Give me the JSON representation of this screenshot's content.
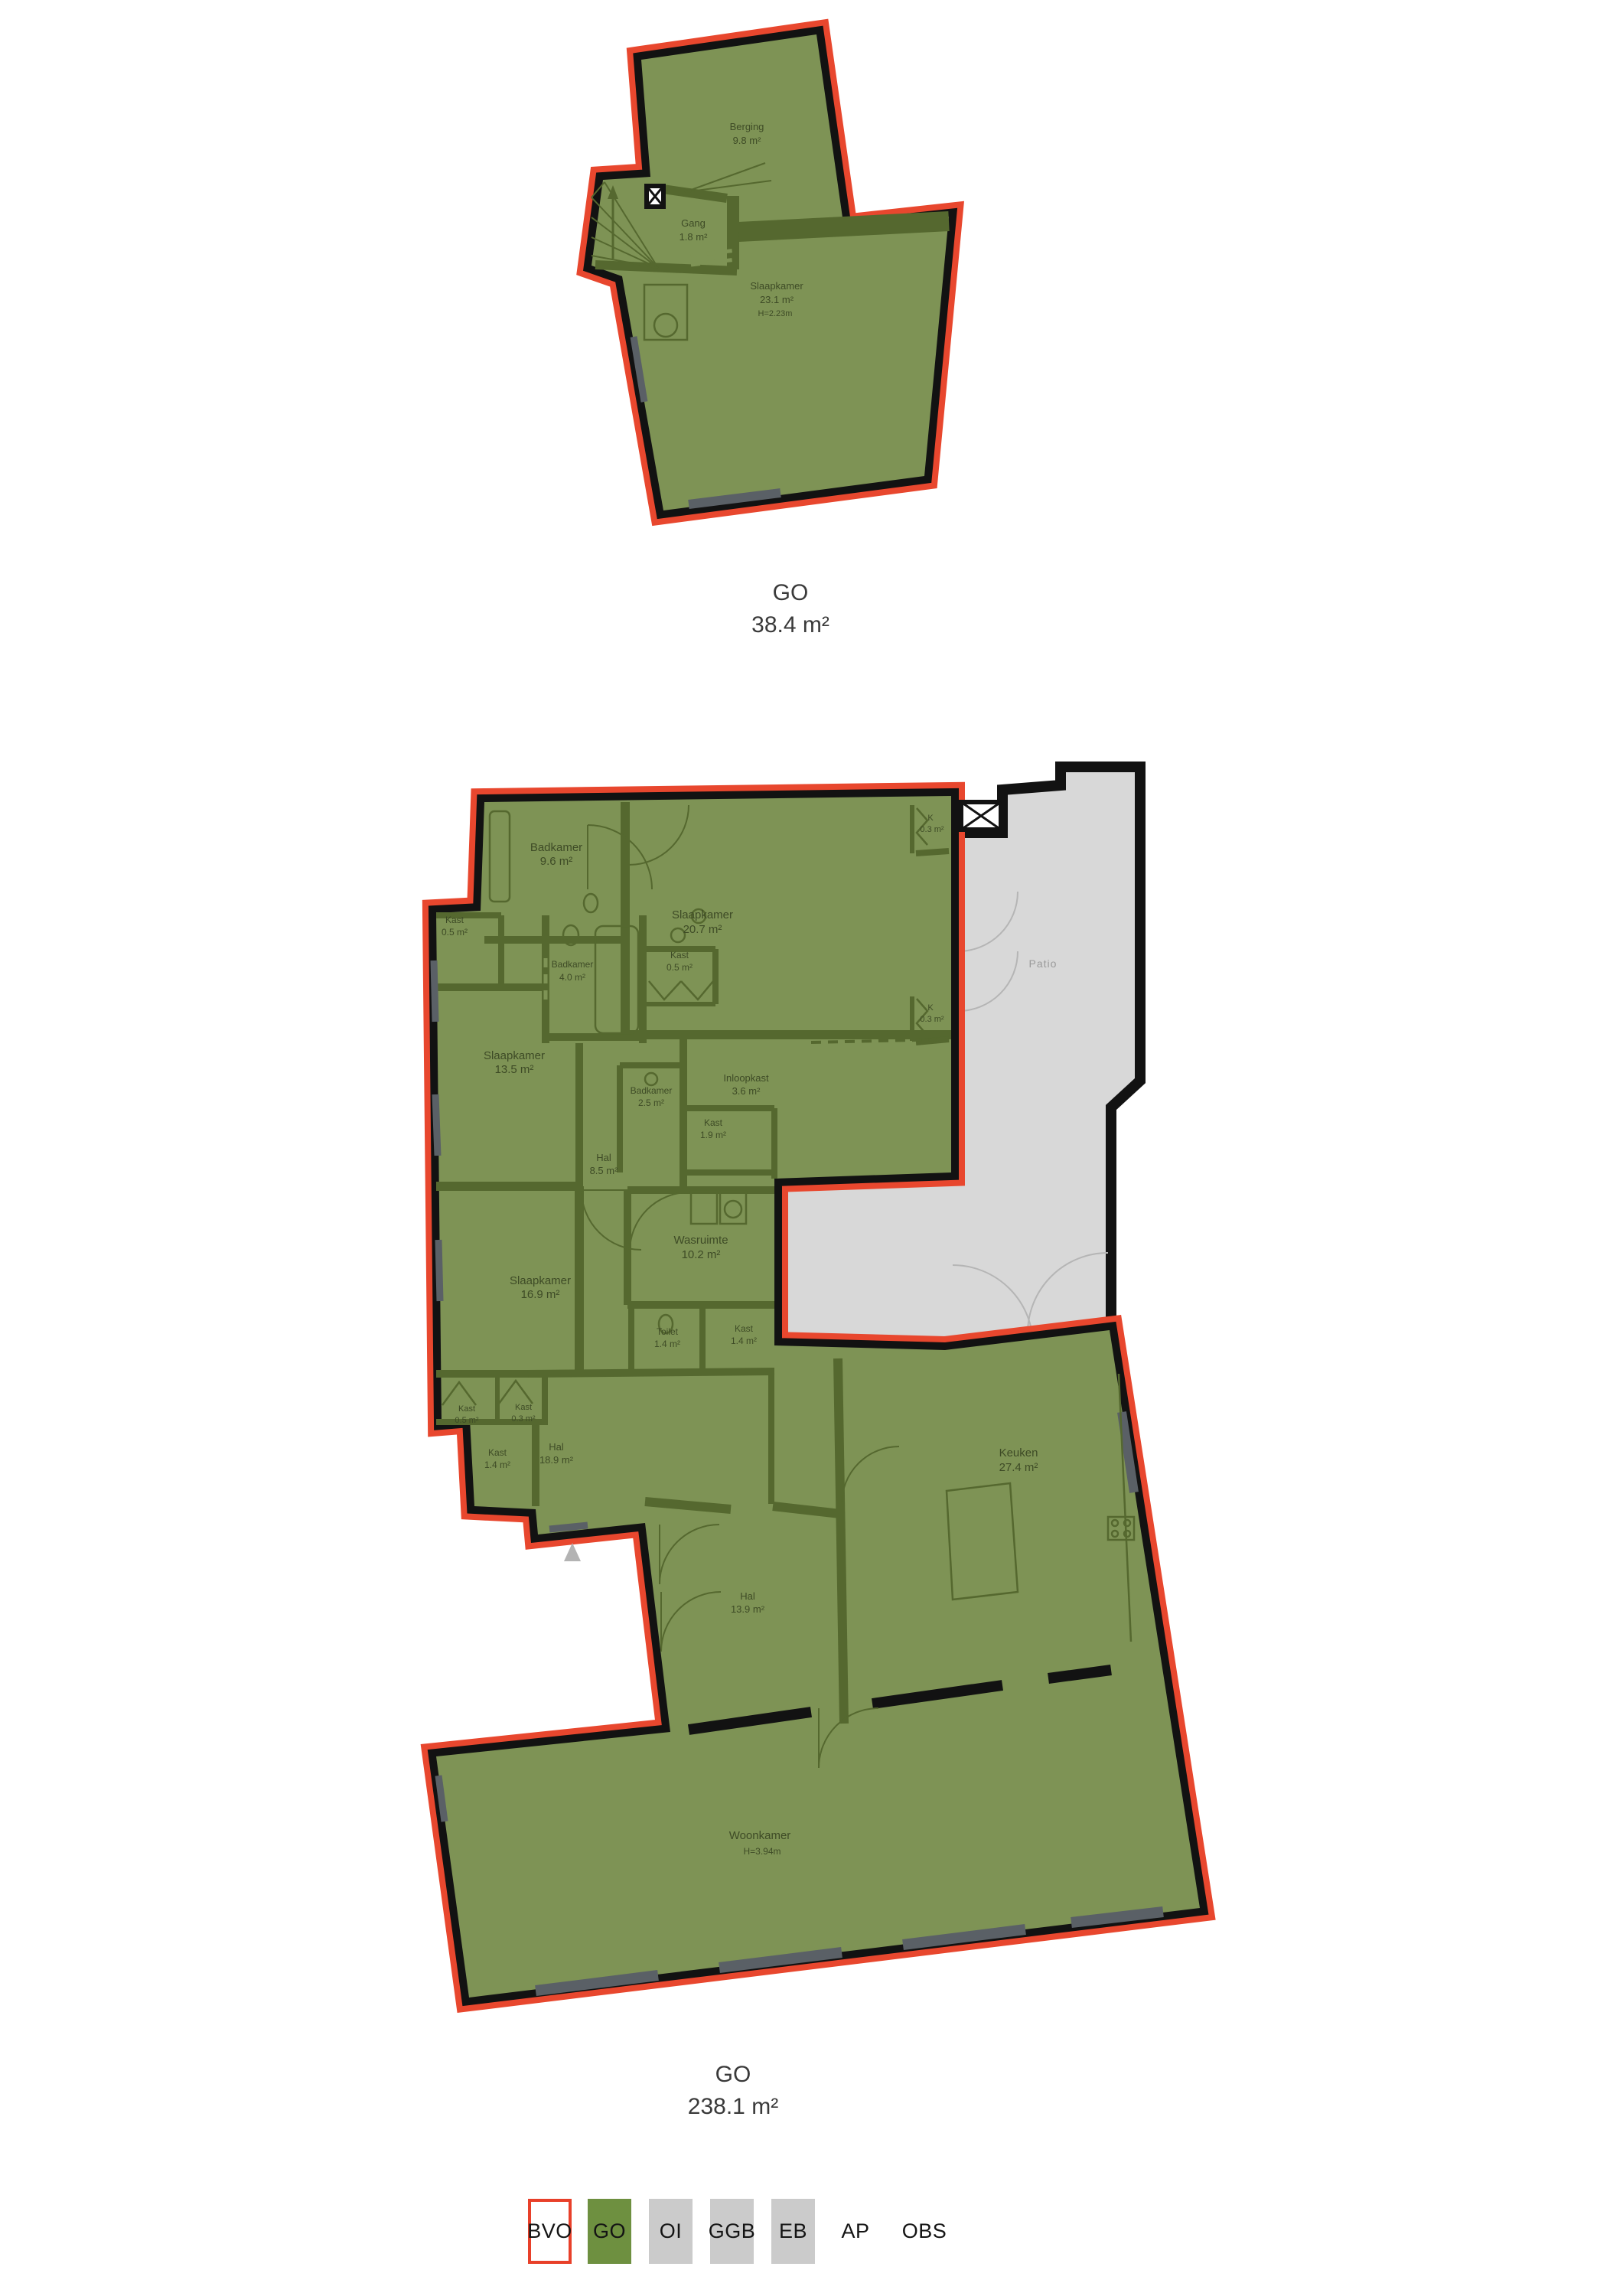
{
  "document": {
    "background": "#ffffff",
    "type": "floor-plan-measurement-drawing"
  },
  "colors": {
    "go_fill": "#7e9355",
    "interior_wall": "#55682f",
    "outline_black": "#121212",
    "outline_red": "#e8472e",
    "patio_fill": "#d8d8d8",
    "room_label_text": "#3e4b26",
    "caption_text": "#3a3a3a",
    "patio_label_text": "#9a9a9a",
    "legend_gray": "#cbcbcb",
    "legend_green": "#6e9040",
    "legend_bvo_border": "#e8402a"
  },
  "plans": [
    {
      "caption": {
        "label": "GO",
        "area": "38.4 m²"
      },
      "rooms": [
        {
          "name": "Berging",
          "area": "9.8 m²"
        },
        {
          "name": "Gang",
          "area": "1.8 m²"
        },
        {
          "name": "Slaapkamer",
          "area": "23.1 m²",
          "height": "H=2.23m"
        }
      ]
    },
    {
      "caption": {
        "label": "GO",
        "area": "238.1 m²"
      },
      "rooms": [
        {
          "name": "Badkamer",
          "area": "9.6 m²"
        },
        {
          "name": "Slaapkamer",
          "area": "20.7 m²"
        },
        {
          "name": "K",
          "area": "0.3 m²"
        },
        {
          "name": "Kast",
          "area": "0.5 m²"
        },
        {
          "name": "Badkamer",
          "area": "4.0 m²"
        },
        {
          "name": "Kast",
          "area": "0.5 m²"
        },
        {
          "name": "K",
          "area": "0.3 m²"
        },
        {
          "name": "Slaapkamer",
          "area": "13.5 m²"
        },
        {
          "name": "Badkamer",
          "area": "2.5 m²"
        },
        {
          "name": "Inloopkast",
          "area": "3.6 m²"
        },
        {
          "name": "Kast",
          "area": "1.9 m²"
        },
        {
          "name": "Hal",
          "area": "8.5 m²"
        },
        {
          "name": "Slaapkamer",
          "area": "16.9 m²"
        },
        {
          "name": "Wasruimte",
          "area": "10.2 m²"
        },
        {
          "name": "Toilet",
          "area": "1.4 m²"
        },
        {
          "name": "Kast",
          "area": "1.4 m²"
        },
        {
          "name": "Kast",
          "area": "0.5 m²"
        },
        {
          "name": "Kast",
          "area": "0.3 m²"
        },
        {
          "name": "Kast",
          "area": "1.4 m²"
        },
        {
          "name": "Hal",
          "area": "18.9 m²"
        },
        {
          "name": "Hal",
          "area": "13.9 m²"
        },
        {
          "name": "Keuken",
          "area": "27.4 m²"
        },
        {
          "name": "Woonkamer",
          "height": "H=3.94m"
        }
      ],
      "patio": {
        "label": "Patio"
      }
    }
  ],
  "legend": {
    "items": [
      {
        "label": "BVO",
        "fill": "#ffffff",
        "border": "#e8402a"
      },
      {
        "label": "GO",
        "fill": "#6e9040"
      },
      {
        "label": "OI",
        "fill": "#cbcbcb"
      },
      {
        "label": "GGB",
        "fill": "#cbcbcb"
      },
      {
        "label": "EB",
        "fill": "#cbcbcb"
      },
      {
        "label": "AP",
        "fill": "none"
      },
      {
        "label": "OBS",
        "fill": "none"
      }
    ]
  }
}
